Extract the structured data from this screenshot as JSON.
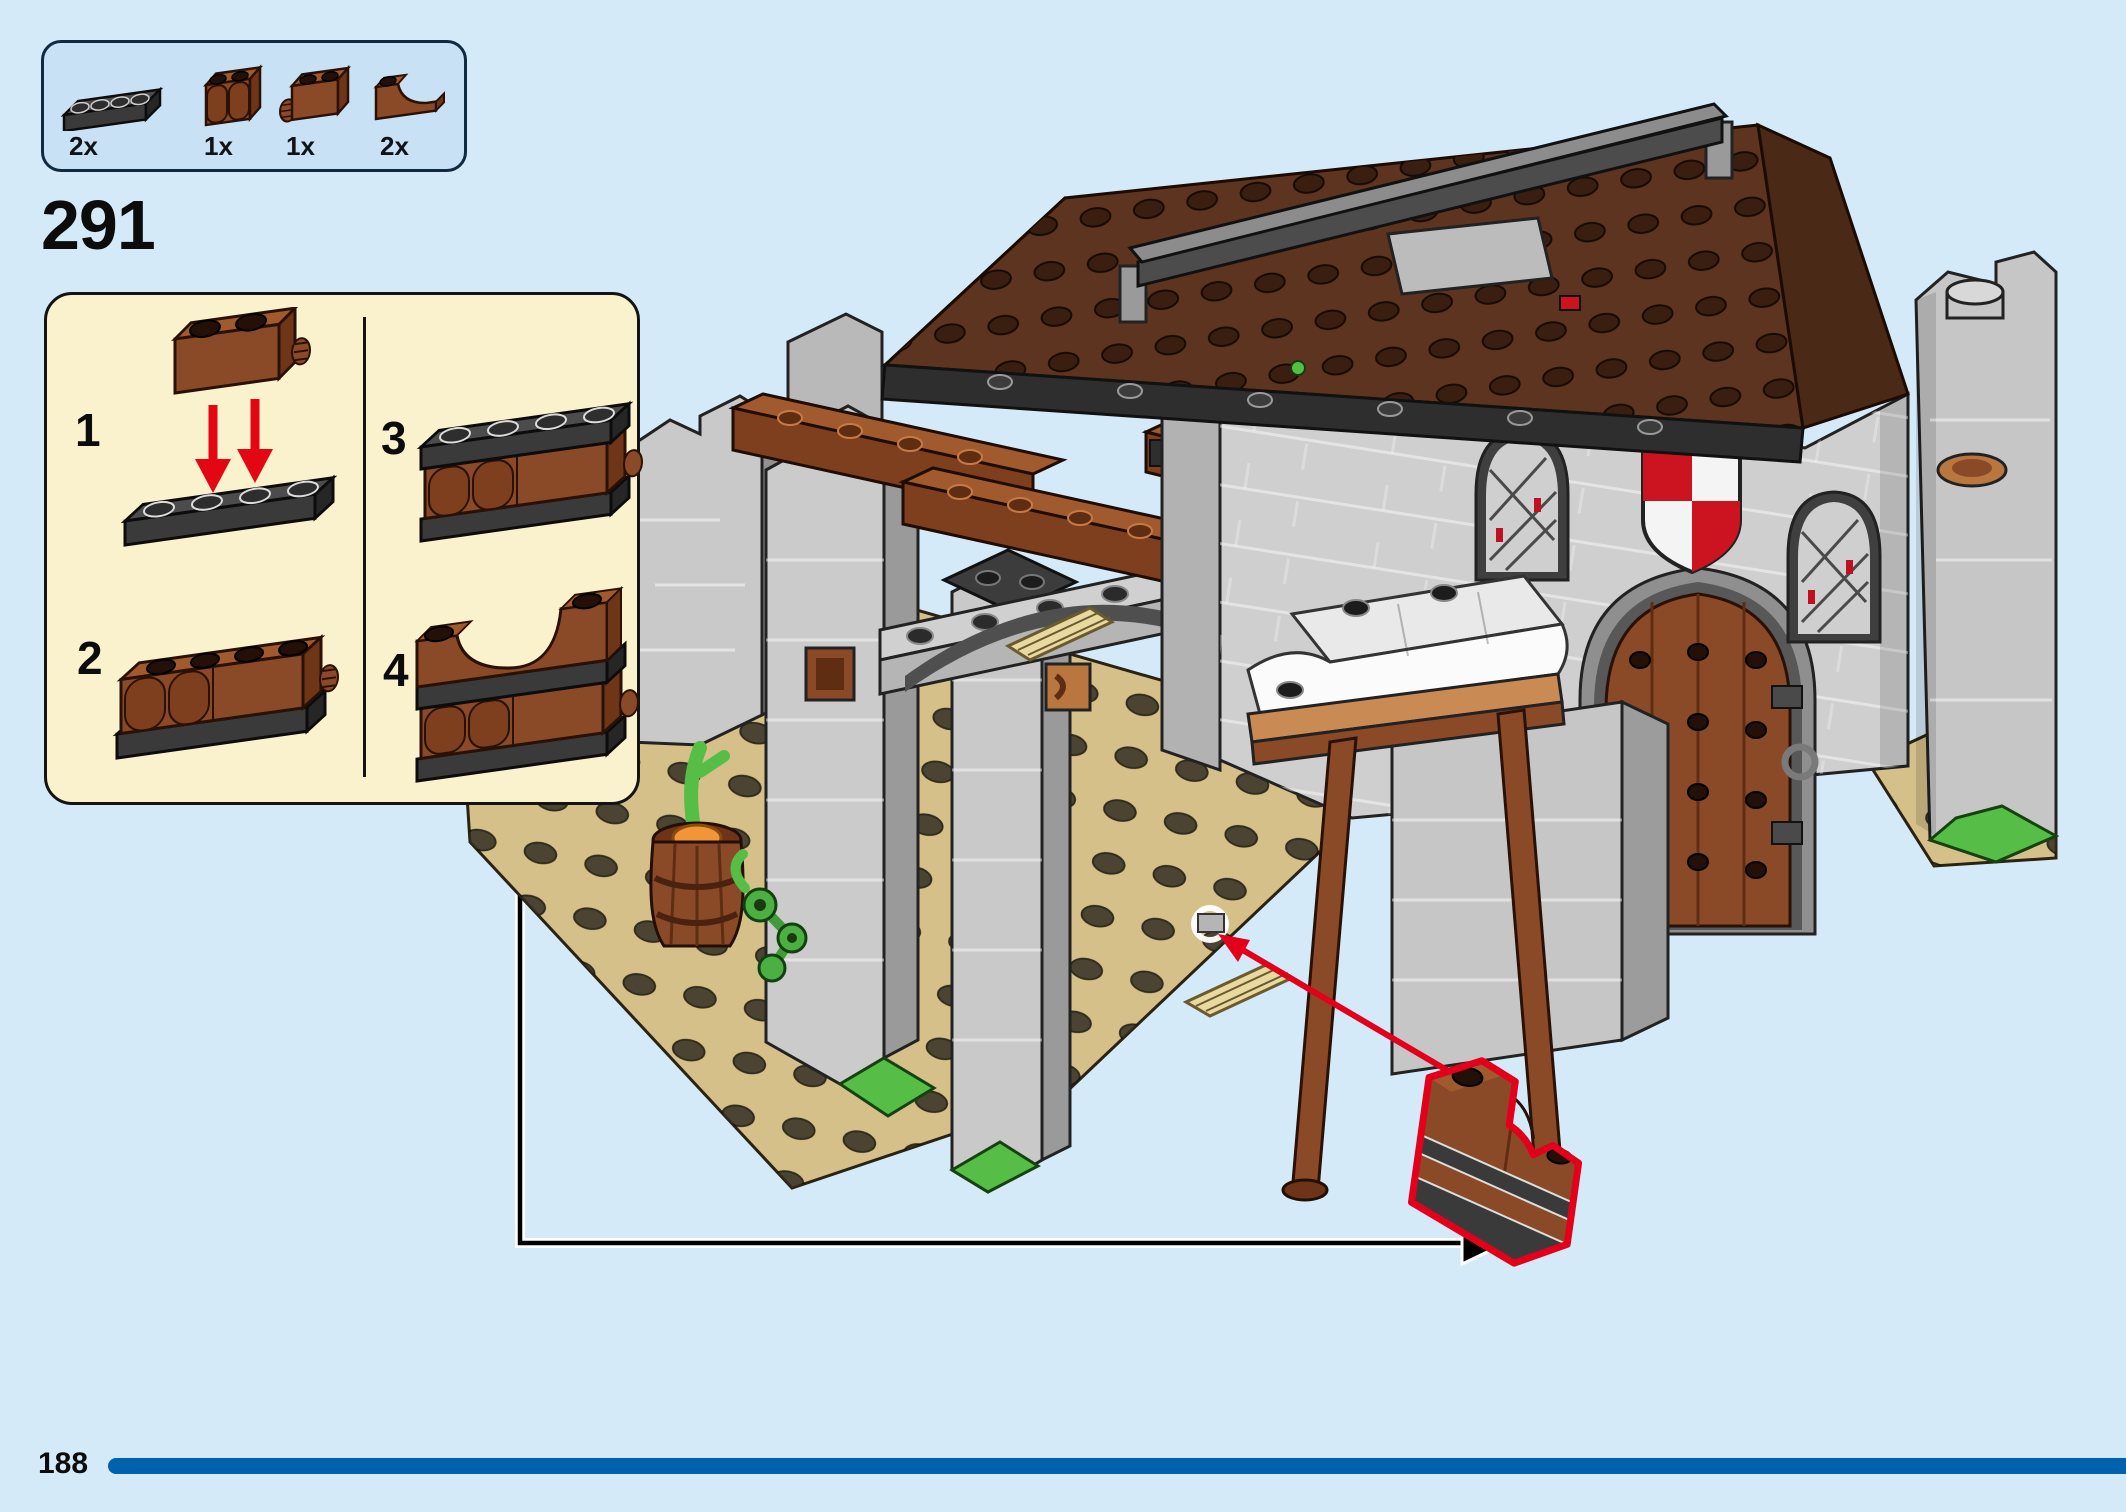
{
  "page": {
    "number": "188",
    "background_color": "#d5eaf8",
    "progress_bar_color": "#0062ac"
  },
  "step": {
    "number": "291"
  },
  "parts_panel": {
    "parts": [
      {
        "qty": "2x",
        "icon": "plate-1x4-dark-gray"
      },
      {
        "qty": "1x",
        "icon": "palisade-brick-1x2-brown"
      },
      {
        "qty": "1x",
        "icon": "hinge-brick-1x2-brown"
      },
      {
        "qty": "2x",
        "icon": "arch-brick-1x2-brown"
      }
    ]
  },
  "substeps": {
    "steps": [
      {
        "num": "1",
        "icon": "hinge-brick-onto-plate"
      },
      {
        "num": "2",
        "icon": "palisade-row-on-plate"
      },
      {
        "num": "3",
        "icon": "plate-on-top-of-row"
      },
      {
        "num": "4",
        "icon": "arch-bricks-on-top"
      }
    ]
  },
  "callout": {
    "highlight_color": "#e3001b",
    "arrow_color": "#000000"
  },
  "model": {
    "name": "medieval-blacksmith-building",
    "elements": [
      "tan-baseplate",
      "stone-ruin-wall",
      "stone-tower",
      "barrel-with-carrot",
      "plant-vine",
      "stone-arch",
      "wood-beams",
      "market-stall-awning",
      "arched-wood-door",
      "red-white-shield",
      "lattice-windows",
      "wood-stud-roof",
      "ridge-beam",
      "rock-tower",
      "wood-pallets",
      "highlighted-new-part"
    ]
  },
  "colors": {
    "brown": "#8a4a28",
    "dark_brown": "#5d341f",
    "tan": "#d5c08a",
    "gray_light": "#cfcfcf",
    "gray_dark": "#9a9a9a",
    "green": "#56be46",
    "red": "#cc1420",
    "black_part": "#3a3a3a",
    "panel_fill": "#c8e1f4",
    "substep_fill": "#faf1cd"
  }
}
